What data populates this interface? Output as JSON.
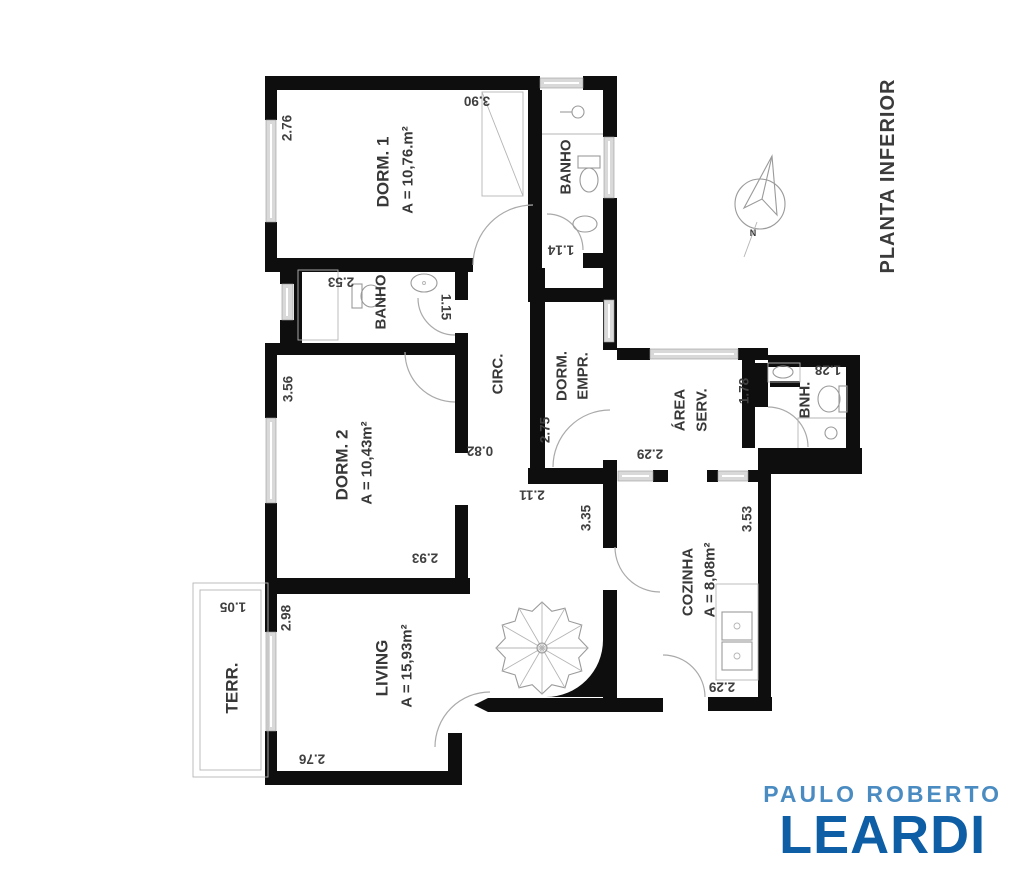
{
  "title": {
    "text": "PLANTA INFERIOR"
  },
  "compass": {
    "label": "N"
  },
  "logo": {
    "line1": "PAULO ROBERTO",
    "line2": "LEARDI",
    "color_line1": "#4a8cc2",
    "color_line2": "#0e5ea6"
  },
  "rooms": {
    "dorm1": {
      "name": "DORM. 1",
      "area": "A = 10,76.m²"
    },
    "dorm2": {
      "name": "DORM. 2",
      "area": "A = 10,43m²"
    },
    "living": {
      "name": "LIVING",
      "area": "A = 15,93m²"
    },
    "cozinha": {
      "name": "COZINHA",
      "area": "A = 8,08m²"
    },
    "banho1": {
      "name": "BANHO"
    },
    "banho2": {
      "name": "BANHO"
    },
    "bnh": {
      "name": "BNH."
    },
    "circ": {
      "name": "CIRC."
    },
    "dorm_empr": {
      "line1": "DORM.",
      "line2": "EMPR."
    },
    "area_serv": {
      "line1": "ÁREA",
      "line2": "SERV."
    },
    "terr": {
      "name": "TERR."
    }
  },
  "dims": {
    "dorm1_left": "2.76",
    "dorm1_top": "3.90",
    "banho1_door": "1.14",
    "banho2_width": "2.53",
    "banho2_door": "1.15",
    "dorm2_left": "3.56",
    "dorm2_bottom": "2.93",
    "circ_opening": "0.82",
    "dorm_empr_height": "2.75",
    "hall_top": "2.11",
    "hall_height": "3.35",
    "area_serv_width": "2.29",
    "area_serv_height": "1.78",
    "bnh_width": "1.28",
    "cozinha_height": "3.53",
    "cozinha_bottom": "2.29",
    "living_left": "2.98",
    "living_bottom": "2.76",
    "terr_top": "1.05"
  }
}
